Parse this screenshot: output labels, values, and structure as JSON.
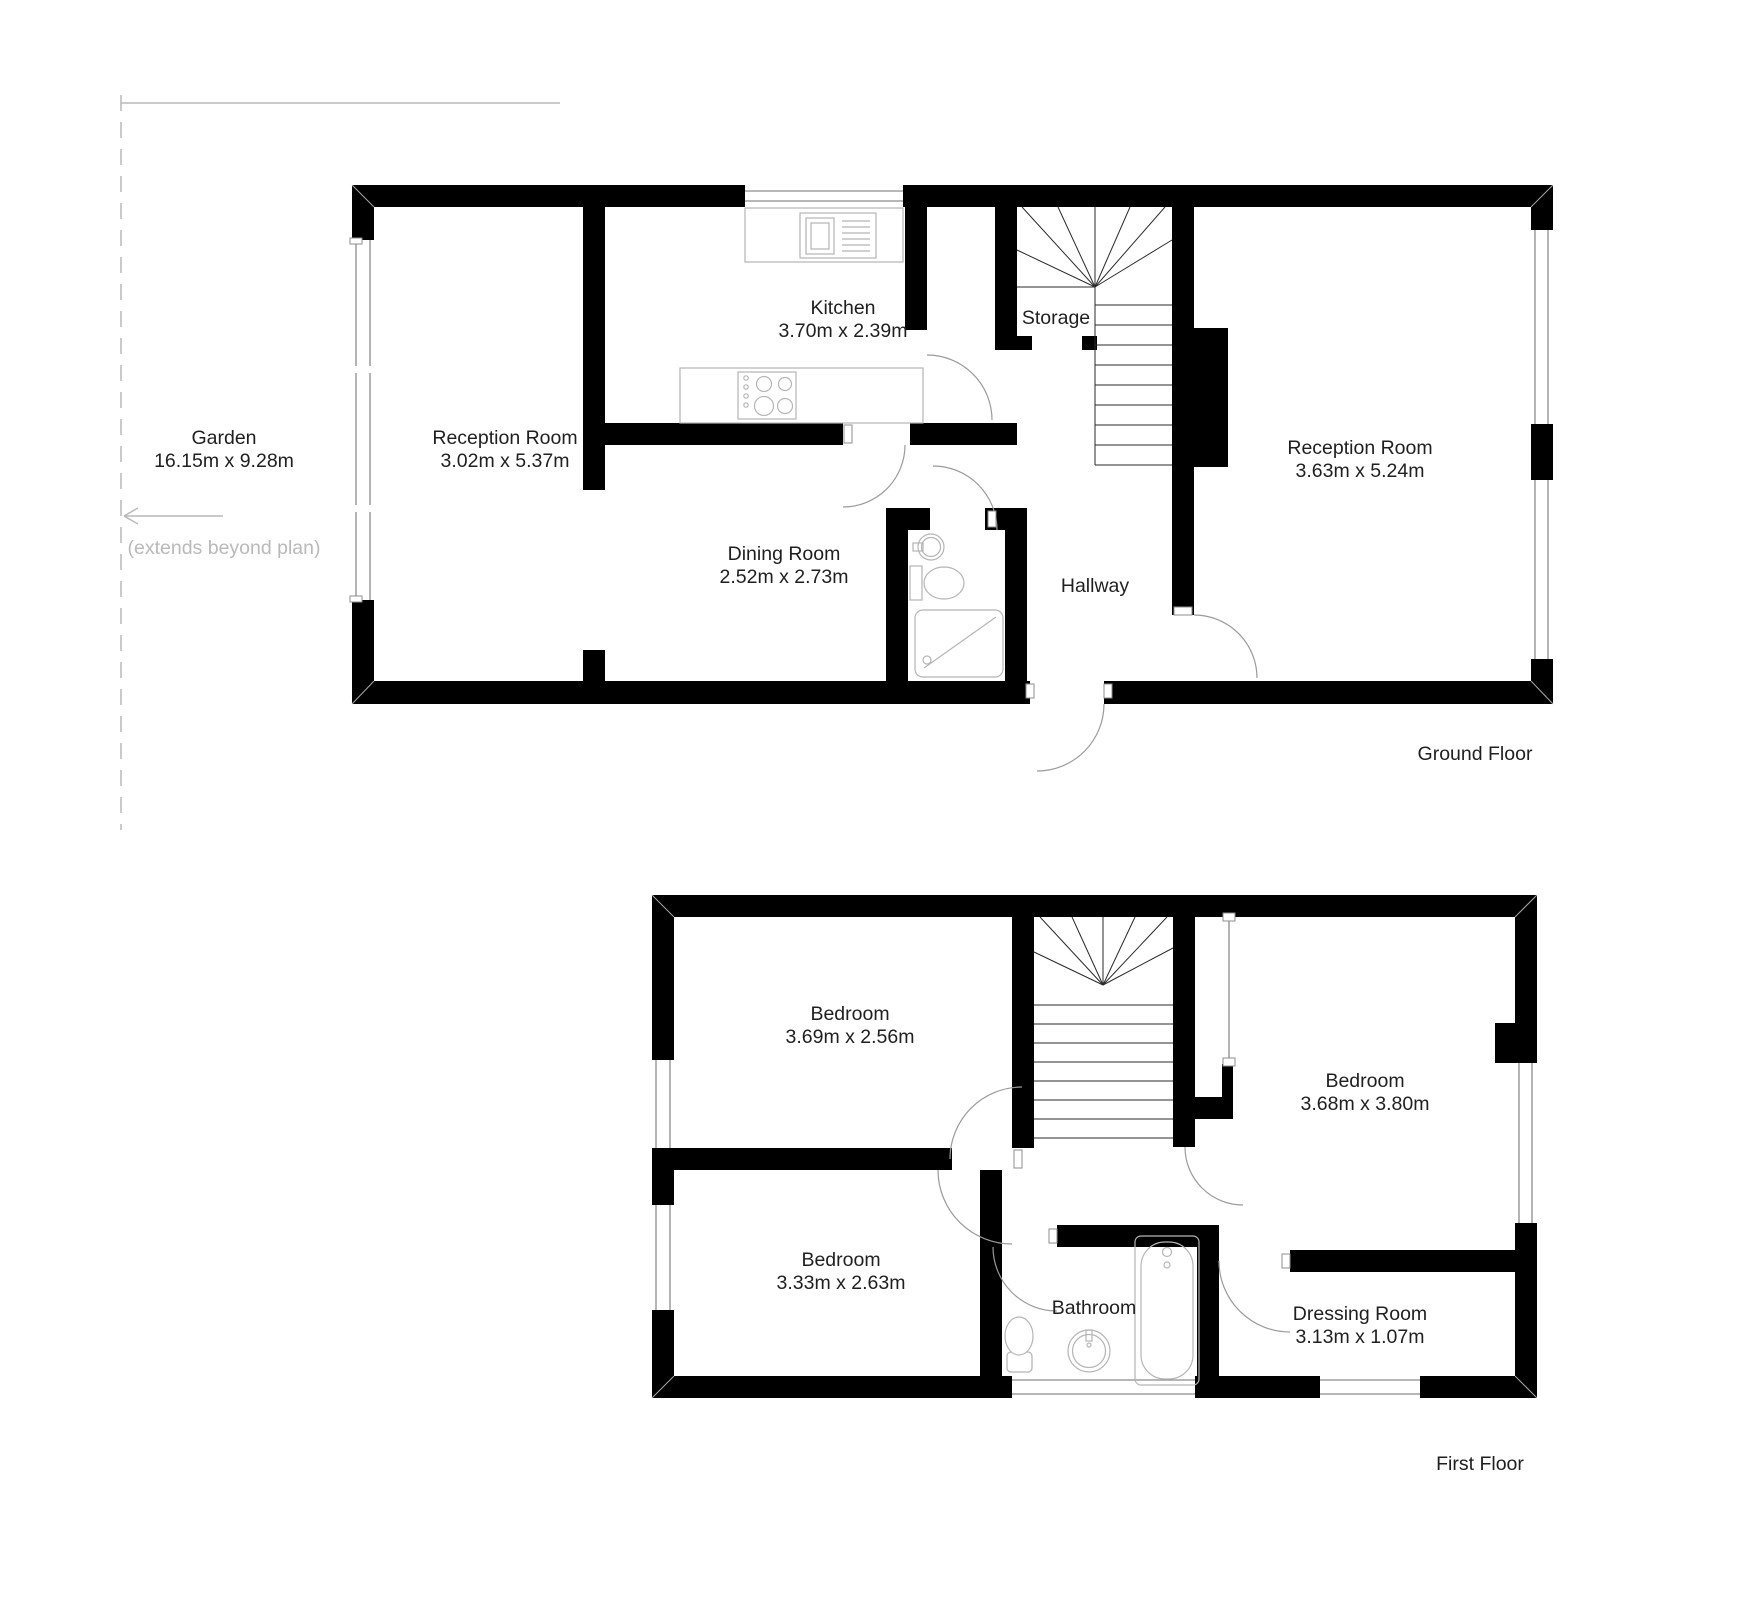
{
  "ground_floor": {
    "title": "Ground Floor",
    "garden": {
      "label": "Garden",
      "dims": "16.15m x 9.28m",
      "note": "(extends beyond plan)"
    },
    "rooms": {
      "reception_left": {
        "label": "Reception Room",
        "dims": "3.02m x 5.37m"
      },
      "kitchen": {
        "label": "Kitchen",
        "dims": "3.70m x 2.39m"
      },
      "dining": {
        "label": "Dining Room",
        "dims": "2.52m x 2.73m"
      },
      "reception_right": {
        "label": "Reception Room",
        "dims": "3.63m x 5.24m"
      },
      "storage": {
        "label": "Storage"
      },
      "hallway": {
        "label": "Hallway"
      }
    }
  },
  "first_floor": {
    "title": "First Floor",
    "rooms": {
      "bedroom_top": {
        "label": "Bedroom",
        "dims": "3.69m x 2.56m"
      },
      "bedroom_right": {
        "label": "Bedroom",
        "dims": "3.68m x 3.80m"
      },
      "bedroom_bottom": {
        "label": "Bedroom",
        "dims": "3.33m x 2.63m"
      },
      "bathroom": {
        "label": "Bathroom"
      },
      "dressing_room": {
        "label": "Dressing Room",
        "dims": "3.13m x 1.07m"
      }
    }
  },
  "colors": {
    "wall": "#000000",
    "fixture": "#b5b5b5",
    "annotation": "#b9b9b9"
  }
}
